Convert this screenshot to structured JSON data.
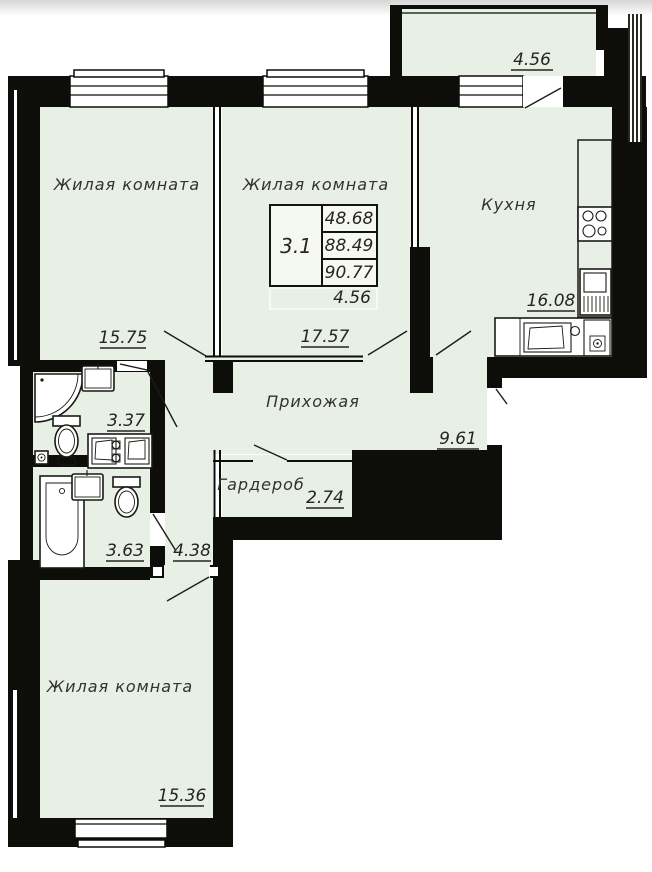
{
  "rooms": {
    "living1": {
      "name": "Жилая комната",
      "area": "15.75"
    },
    "living2": {
      "name": "Жилая комната",
      "area": "17.57"
    },
    "kitchen": {
      "name": "Кухня",
      "area": "16.08"
    },
    "hallway": {
      "name": "Прихожая",
      "area": "9.61"
    },
    "wardrobe": {
      "name": "Гардероб",
      "area": "2.74"
    },
    "bathroom_small": {
      "area": "3.37"
    },
    "bathroom_large": {
      "area": "3.63"
    },
    "corridor": {
      "area": "4.38"
    },
    "living3": {
      "name": "Жилая комната",
      "area": "15.36"
    },
    "balcony": {
      "area": "4.56"
    }
  },
  "stamp": {
    "plan_number": "3.1",
    "living_area": "48.68",
    "floor_area": "88.49",
    "total_area": "90.77",
    "balcony_area": "4.56"
  },
  "colors": {
    "floor": "#e8efe5",
    "wall": "#0d0d0a"
  }
}
